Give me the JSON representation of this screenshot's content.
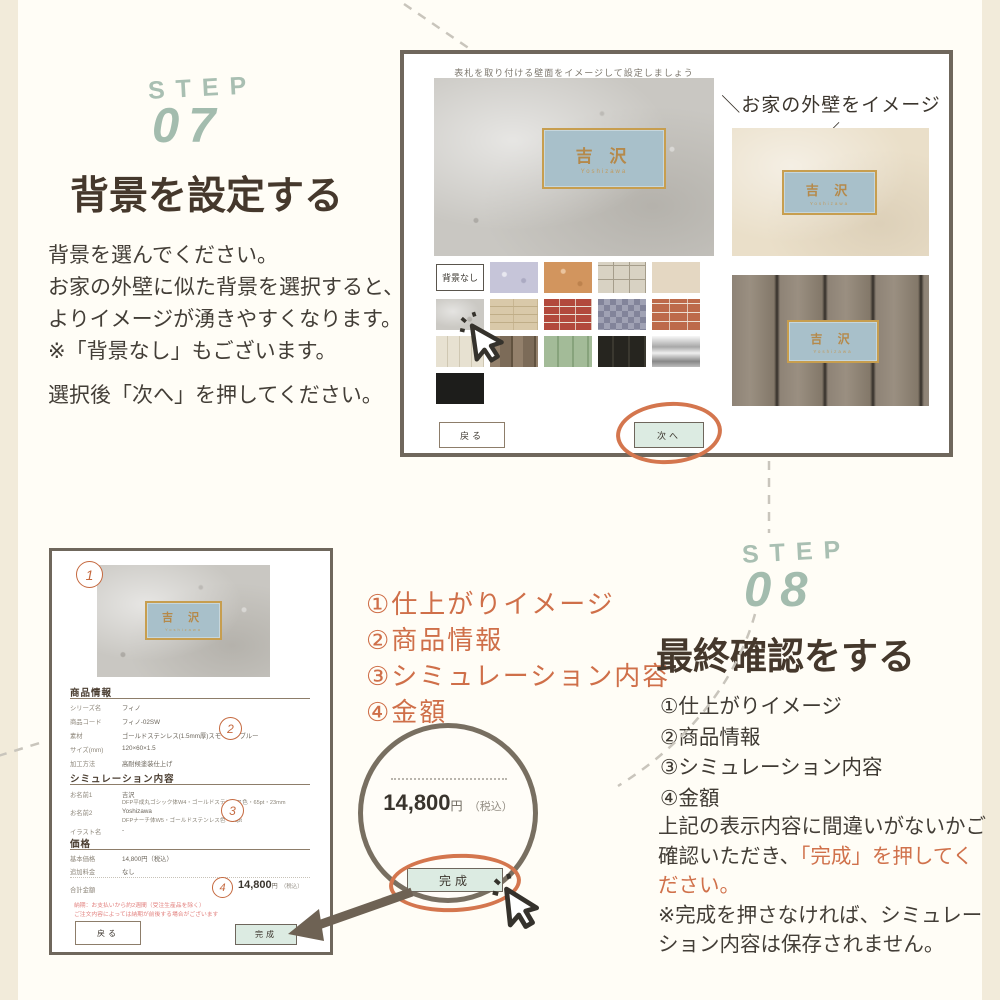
{
  "palette": {
    "background": "#fffdf6",
    "edge_strip": "#f2ebda",
    "step_teal": "#a3bcae",
    "heading_brown": "#45382c",
    "accent_orange": "#d0714b",
    "mint_button": "#dcebe2",
    "frame_border": "#6f675c",
    "plate_blue": "#a8c0ca",
    "plate_gold": "#c79e4f",
    "note_pink": "#e2807e"
  },
  "icons": {
    "cursor1": "click-pointer-icon",
    "cursor2": "click-pointer-icon",
    "arrow": "thick-left-arrow-icon",
    "magnifier": "zoom-circle",
    "ellipse1": "hand-drawn-circle-next",
    "ellipse2": "hand-drawn-circle-complete",
    "dashes": "decorative-dashed-lines"
  },
  "step07": {
    "step_word": "STEP",
    "number": "07",
    "title": "背景を設定する",
    "body_lines": [
      "背景を選んでください。",
      "お家の外壁に似た背景を選択すると、",
      "よりイメージが湧きやすくなります。",
      "※「背景なし」もございます。"
    ],
    "action_line": "選択後「次へ」を押してください。"
  },
  "simulator_screen": {
    "header": "表札を取り付ける壁面をイメージして設定しましょう",
    "nameplate": {
      "name": "吉 沢",
      "romaji": "Yoshizawa"
    },
    "no_background_label": "背景なし",
    "swatch_names": [
      "lavender-stucco",
      "orange-stucco",
      "beige-tile",
      "light-beige",
      "gray-concrete",
      "beige-stone",
      "red-brick",
      "checkered-gray",
      "orange-brick",
      "cream-siding",
      "brown-wood",
      "green-wood",
      "black-wood",
      "silver-metal",
      "black"
    ],
    "back_button": "戻る",
    "next_button": "次へ",
    "wall_annotation": "＼お家の外壁をイメージ／"
  },
  "confirm_screen": {
    "badges": {
      "b1": "1",
      "b2": "2",
      "b3": "3",
      "b4": "4"
    },
    "product_section": {
      "title": "商品情報",
      "rows": [
        {
          "label": "シリーズ名",
          "value": "フィノ"
        },
        {
          "label": "商品コード",
          "value": "フィノ-02SW"
        },
        {
          "label": "素材",
          "value": "ゴールドステンレス(1.5mm厚)スモーキーブルー"
        },
        {
          "label": "サイズ(mm)",
          "value": "120×60×1.5"
        },
        {
          "label": "加工方法",
          "value": "高耐候塗装仕上げ"
        }
      ]
    },
    "sim_section": {
      "title": "シミュレーション内容",
      "rows": [
        {
          "label": "お名前1",
          "value": "吉沢",
          "detail": "DFP平成丸ゴシック体W4・ゴールドステンレス色・65pt・23mm"
        },
        {
          "label": "お名前2",
          "value": "Yoshizawa",
          "detail": "DFPナーチ体W5・ゴールドステンレス色・26pt"
        },
        {
          "label": "イラスト名",
          "value": "-",
          "detail": ""
        }
      ]
    },
    "price_section": {
      "title": "価格",
      "rows": [
        {
          "label": "基本価格",
          "value": "14,800円（税込）"
        },
        {
          "label": "追加料金",
          "value": "なし"
        }
      ],
      "total_label": "合計金額",
      "total_value": "14,800",
      "total_unit": "円",
      "total_tax": "（税込）"
    },
    "note_lines": [
      "納期：お支払いから約2週間（受注生産品を除く）",
      "ご注文内容によっては納期が前後する場合がございます"
    ],
    "back_button": "戻る",
    "complete_button": "完成"
  },
  "magnifier": {
    "price": "14,800",
    "unit": "円",
    "tax": "（税込）",
    "button": "完成"
  },
  "callout_list": {
    "item1": "①仕上がりイメージ",
    "item2": "②商品情報",
    "item3": "③シミュレーション内容",
    "item4": "④金額"
  },
  "step08": {
    "step_word": "STEP",
    "number": "08",
    "title": "最終確認をする",
    "list_items": {
      "i1": "①仕上がりイメージ",
      "i2": "②商品情報",
      "i3": "③シミュレーション内容",
      "i4": "④金額"
    },
    "para_before": "上記の表示内容に間違いがないかご確認いただき、",
    "para_orange": "「完成」を押してください。",
    "para_after": "※完成を押さなければ、シミュレーション内容は保存されません。"
  }
}
